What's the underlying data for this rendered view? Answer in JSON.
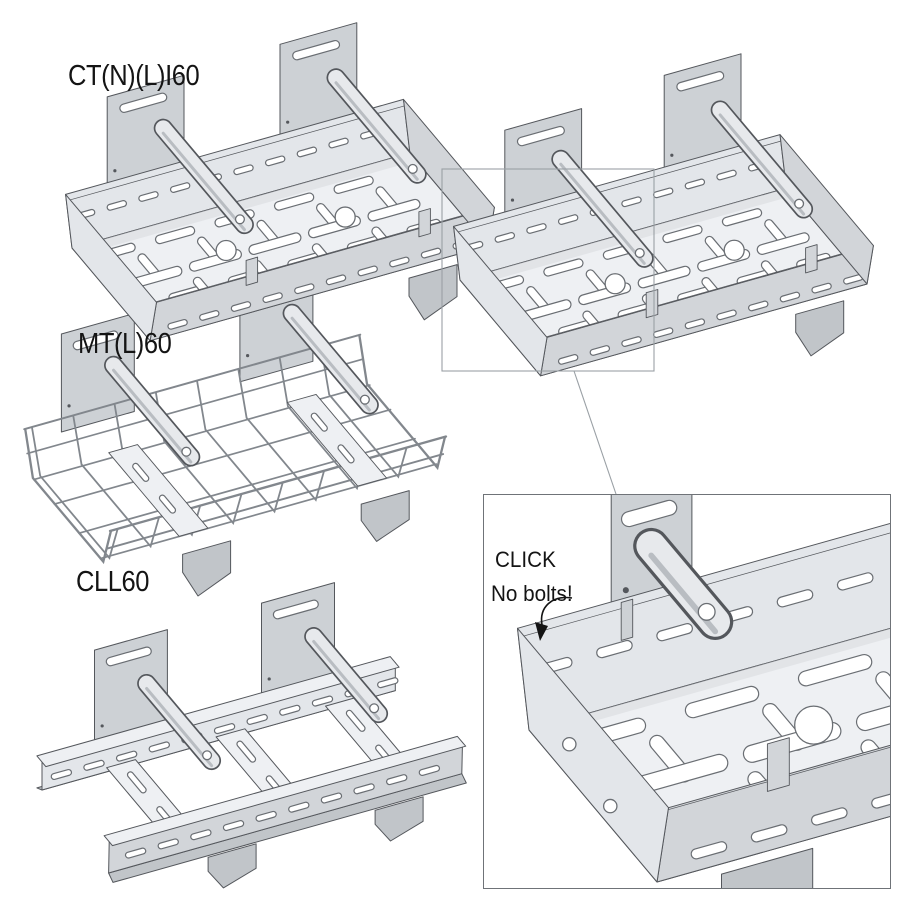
{
  "page": {
    "width": 908,
    "height": 908,
    "background": "#ffffff"
  },
  "products": [
    {
      "label": "CT(N)(L)I60",
      "kind": "perforated cable tray with click hanger brackets"
    },
    {
      "label": "MT(L)60",
      "kind": "wire mesh cable tray with click hanger brackets"
    },
    {
      "label": "CLL60",
      "kind": "cable ladder with click hanger brackets"
    }
  ],
  "detail_inset": {
    "line1": "CLICK",
    "line2": "No bolts!"
  },
  "colors": {
    "outline": "#54575c",
    "slot_outline": "#6a6e73",
    "steel_top": "#eef0f3",
    "steel_light": "#e3e6ea",
    "steel_mid": "#d2d5d9",
    "steel_dark": "#c1c5c9",
    "steel_plate": "#cdd1d5",
    "arm_top": "#e7e9ec",
    "arm_side": "#b9bdc2",
    "mesh_wire": "#82878d",
    "callout_line": "#9aa0a5",
    "inset_border": "#6f7378",
    "text": "#141414",
    "white": "#ffffff"
  }
}
